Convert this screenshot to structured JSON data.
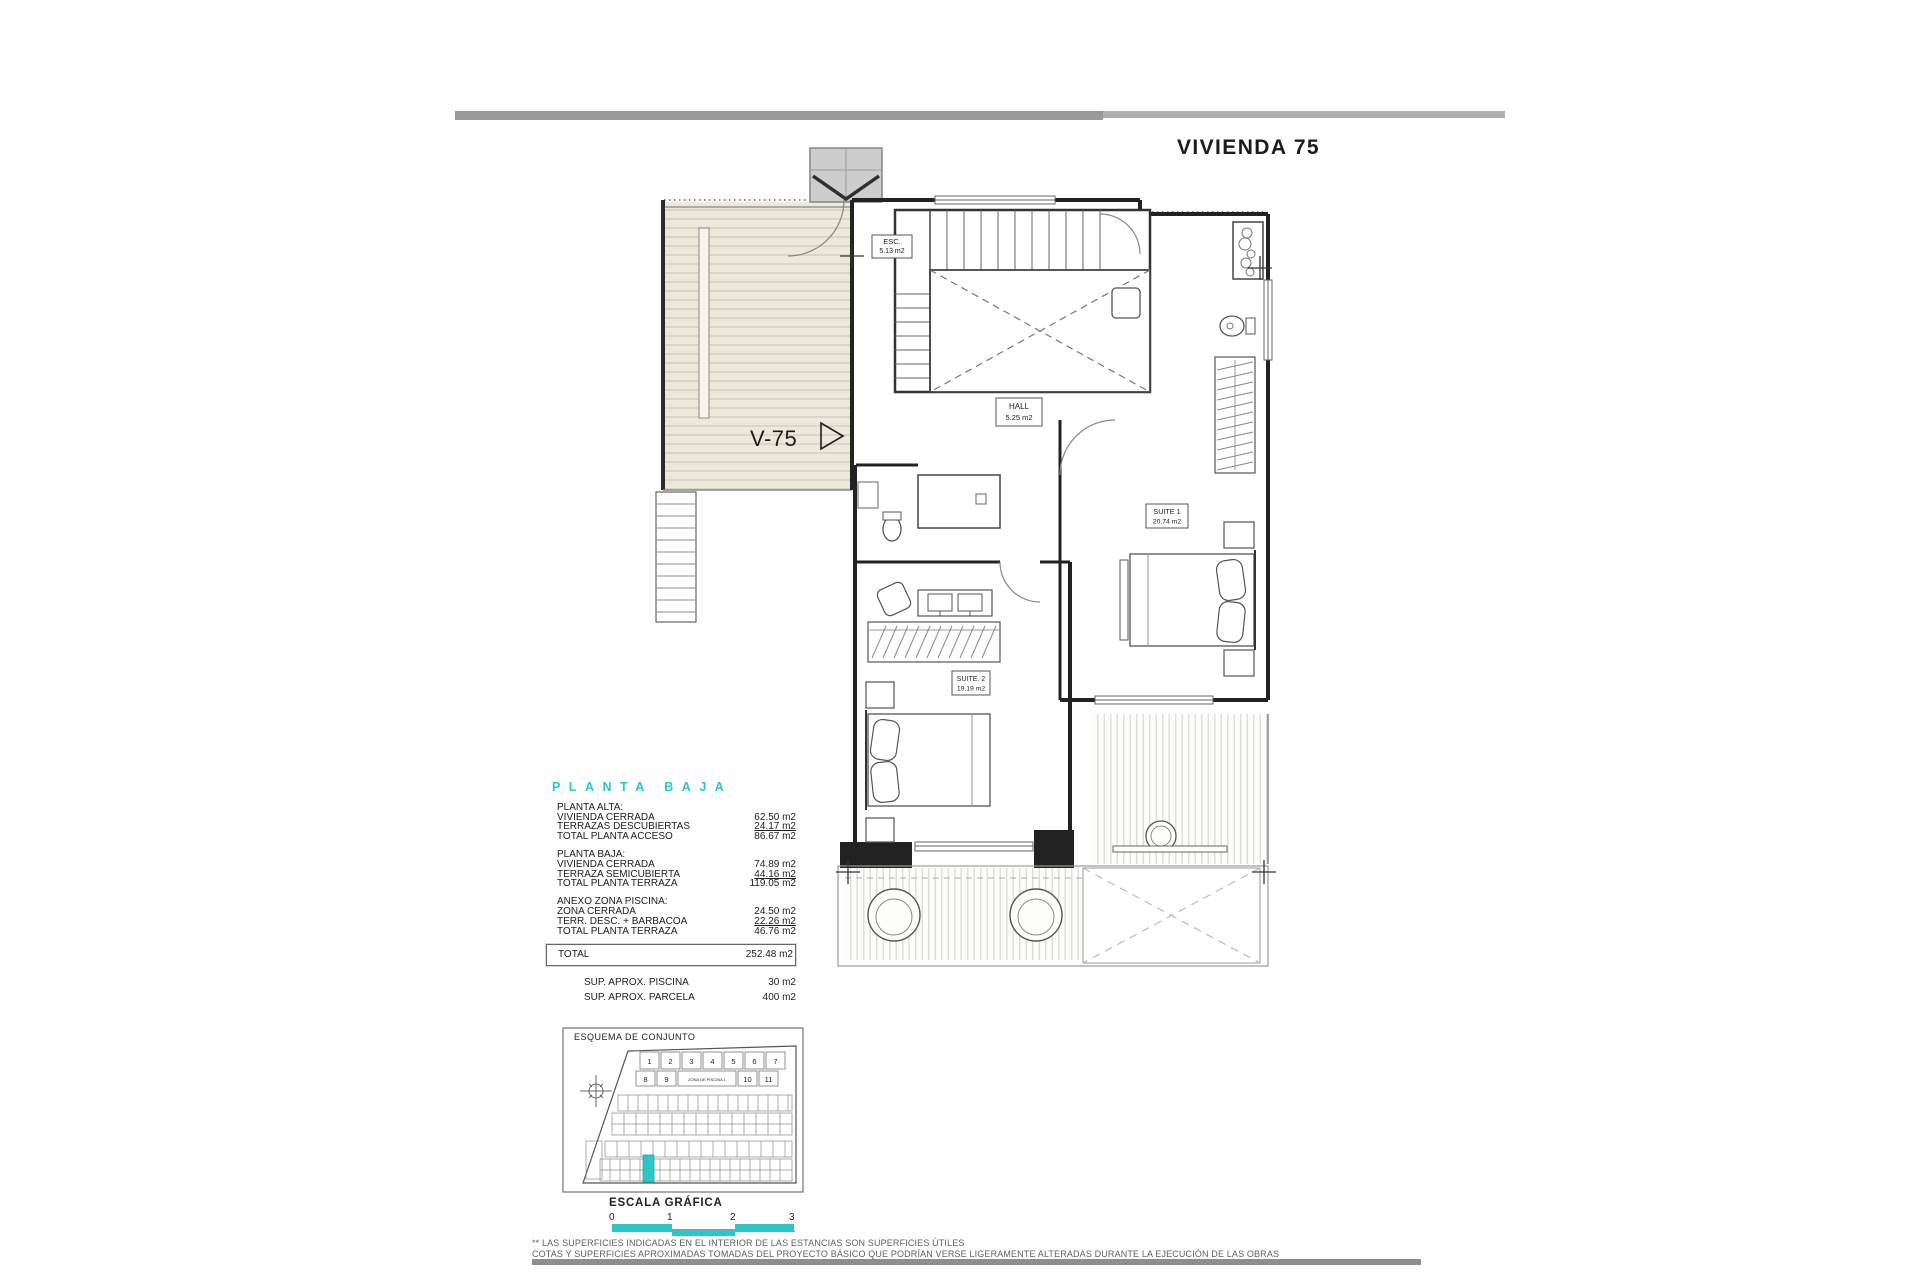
{
  "accent": "#2cc6c6",
  "title": "VIVIENDA 75",
  "plan": {
    "unit_label": "V-75",
    "rooms": {
      "esc": {
        "name": "ESC.",
        "area": "5.13 m2"
      },
      "hall": {
        "name": "HALL",
        "area": "5.25 m2"
      },
      "suite1": {
        "name": "SUITE 1",
        "area": "20.74 m2"
      },
      "suite2": {
        "name": "SUITE. 2",
        "area": "19.19 m2"
      }
    }
  },
  "areas": {
    "section_title": "PLANTA BAJA",
    "groups": [
      {
        "heading": "PLANTA ALTA:",
        "rows": [
          {
            "label": "VIVIENDA CERRADA",
            "value": "62.50 m2"
          },
          {
            "label": "TERRAZAS DESCUBIERTAS",
            "value": "24.17 m2"
          },
          {
            "label": "TOTAL PLANTA ACCESO",
            "value": "86.67 m2"
          }
        ]
      },
      {
        "heading": "PLANTA BAJA:",
        "rows": [
          {
            "label": "VIVIENDA CERRADA",
            "value": "74.89 m2"
          },
          {
            "label": "TERRAZA SEMICUBIERTA",
            "value": "44.16 m2"
          },
          {
            "label": "TOTAL PLANTA TERRAZA",
            "value": "119.05 m2"
          }
        ]
      },
      {
        "heading": "ANEXO ZONA PISCINA:",
        "rows": [
          {
            "label": "ZONA CERRADA",
            "value": "24.50 m2"
          },
          {
            "label": "TERR. DESC. + BARBACOA",
            "value": "22.26 m2"
          },
          {
            "label": "TOTAL PLANTA TERRAZA",
            "value": "46.76 m2"
          }
        ]
      }
    ],
    "total": {
      "label": "TOTAL",
      "value": "252.48 m2"
    },
    "extras": [
      {
        "label": "SUP. APROX. PISCINA",
        "value": "30 m2"
      },
      {
        "label": "SUP. APROX. PARCELA",
        "value": "400 m2"
      }
    ]
  },
  "site": {
    "header": "ESQUEMA DE CONJUNTO",
    "row1": [
      "1",
      "2",
      "3",
      "4",
      "5",
      "6",
      "7"
    ],
    "row2_left": [
      "8",
      "9"
    ],
    "pool_label": "ZONA DE PISCINA 1",
    "row2_right": [
      "10",
      "11"
    ]
  },
  "scale": {
    "header": "ESCALA GRÁFICA",
    "ticks": [
      "0",
      "1",
      "2",
      "3"
    ]
  },
  "footer": {
    "line1": "** LAS SUPERFICIES INDICADAS EN EL INTERIOR DE LAS ESTANCIAS SON SUPERFICIES ÚTILES",
    "line2": "COTAS Y SUPERFICIES APROXIMADAS TOMADAS DEL PROYECTO BÁSICO QUE PODRÍAN VERSE LIGERAMENTE ALTERADAS DURANTE LA EJECUCIÓN DE LAS OBRAS"
  }
}
